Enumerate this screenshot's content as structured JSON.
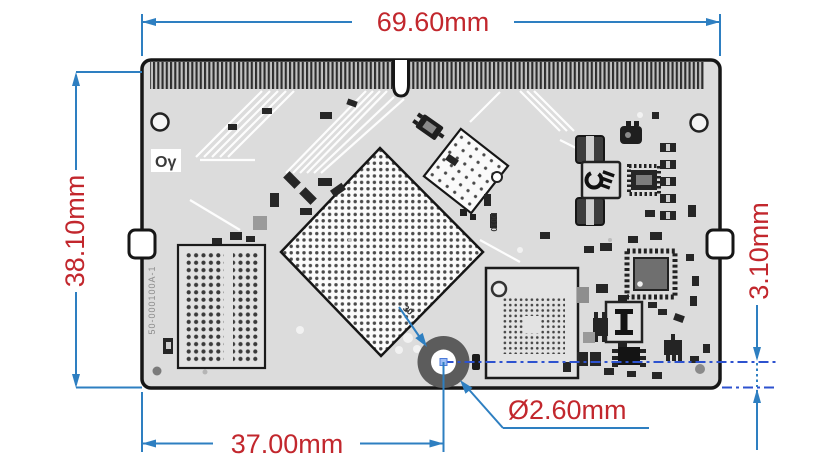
{
  "drawing": {
    "title": "PCB module mechanical dimension drawing",
    "colors": {
      "dimension_blue": "#2e7fc1",
      "centerline_blue": "#2d52cf",
      "label_red": "#c2272d",
      "board_fill": "#dcdcdc",
      "outline_black": "#161616"
    },
    "dimensions": {
      "board_width": "69.60mm",
      "board_height": "38.10mm",
      "hole_from_left_edge": "37.00mm",
      "hole_from_bottom_edge": "3.10mm",
      "hole_diameter": "Ø2.60mm"
    },
    "silkscreen": {
      "logo": "Oγ",
      "part_number": "50-000100A-1",
      "ref_d010": "D010",
      "ref_30": "30"
    }
  }
}
